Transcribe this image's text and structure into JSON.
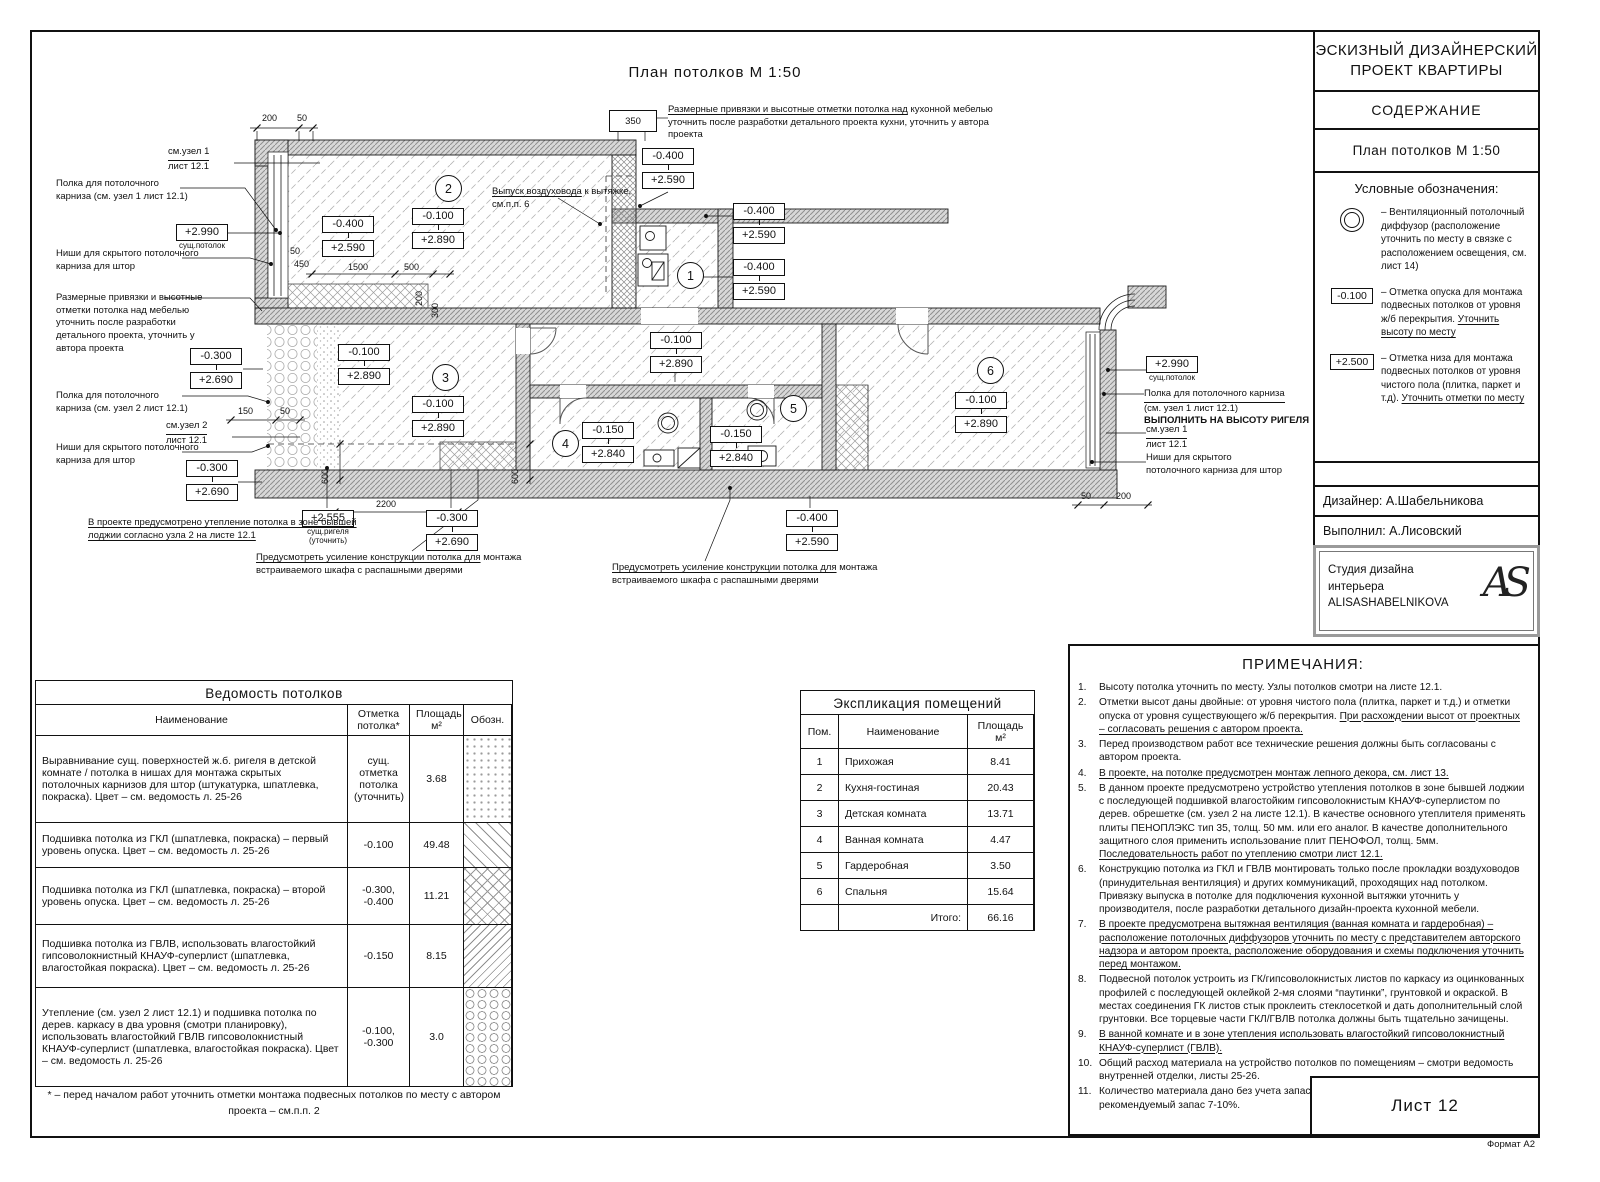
{
  "sheet": {
    "format": "Формат А2",
    "number": "Лист 12"
  },
  "plan": {
    "title": "План потолков М 1:50",
    "room_numbers": [
      "1",
      "2",
      "3",
      "4",
      "5",
      "6"
    ],
    "marks": {
      "m0400": "-0.400",
      "p2590": "+2.590",
      "m0100": "-0.100",
      "p2890": "+2.890",
      "m0300": "-0.300",
      "p2690": "+2.690",
      "m0150": "-0.150",
      "p2840": "+2.840",
      "p2990": "+2.990",
      "p2555": "+2.555"
    },
    "mark_captions": {
      "exist_ceiling": "сущ.потолок",
      "exist_beam": "сущ.ригеля\n(уточнить)"
    },
    "dims": {
      "d200": "200",
      "d50": "50",
      "d350": "350",
      "d150": "150",
      "d450": "450",
      "d1500": "1500",
      "d500": "500",
      "d300": "300",
      "d600": "600",
      "d2200": "2200"
    },
    "ann": {
      "see_node1": "см.узел 1",
      "see_node2": "см.узел 2",
      "sheet_ref": "лист 12.1",
      "shelf_node1_l1": "Полка для потолочного",
      "shelf_node1_l2": "карниза (см. узел 1 лист 12.1)",
      "shelf_node2_l1": "Полка для потолочного",
      "shelf_node2_l2": "карниза (см. узел 2 лист 12.1)",
      "niche_l1": "Ниши для скрытого потолочного",
      "niche_l2": "карниза для штор",
      "furniture_note": "Размерные привязки и высотные отметки потолка над мебелью уточнить после разработки детального проекта, уточнить у автора проекта",
      "kitchen_note_u": "Размерные привязки и высотные отметки потолка над",
      "kitchen_note_rest": "кухонной мебелью уточнить после разработки детального проекта кухни, уточнить у автора проекта",
      "duct_note_u": "Выпуск воздуховода",
      "duct_note_rest": "к вытяжке, см.п.п. 6",
      "insulation_note": "В проекте предусмотрено утепление потолка в зоне бывшей лоджии согласно узла 2 на листе 12.1",
      "wardrobe_note_u": "Предусмотреть усиление конструкции потолка для",
      "wardrobe_note_rest": "монтажа встраиваемого шкафа с распашными дверями",
      "shelf_r_l1": "Полка для потолочного карниза",
      "shelf_r_l2": "(см. узел 1 лист 12.1)",
      "beam_height_note": "ВЫПОЛНИТЬ НА ВЫСОТУ РИГЕЛЯ",
      "niche_r_l1": "Ниши для скрытого",
      "niche_r_l2": "потолочного карниза для штор"
    }
  },
  "titleblock": {
    "project_title": "ЭСКИЗНЫЙ ДИЗАЙНЕРСКИЙ\nПРОЕКТ КВАРТИРЫ",
    "contents": "СОДЕРЖАНИЕ",
    "sheet_title": "План потолков М 1:50",
    "legend_title": "Условные обозначения:",
    "leg1_text": "–  Вентиляционный потолочный диффузор (расположение уточнить по месту в связке с расположением освещения, см. лист 14)",
    "leg2_mark": "-0.100",
    "leg2_text": "–  Отметка опуска для монтажа подвесных потолков от уровня ж/б перекрытия. ",
    "leg2_underline": "Уточнить высоту по месту",
    "leg3_mark": "+2.500",
    "leg3_text": "–  Отметка низа для монтажа подвесных потолков от уровня чистого пола (плитка, паркет и т.д). ",
    "leg3_underline": "Уточнить отметки по месту",
    "designer": "Дизайнер:  А.Шабельникова",
    "executor": "Выполнил:  А.Лисовский",
    "studio": "Студия дизайна\nинтерьера\nALISASHABELNIKOVA",
    "logo": "AS"
  },
  "ceiling_table": {
    "title": "Ведомость потолков",
    "h_name": "Наименование",
    "h_mark": "Отметка потолка*",
    "h_area": "Площадь м²",
    "h_sym": "Обозн.",
    "rows": [
      {
        "name": "Выравнивание сущ. поверхностей ж.б. ригеля в детской комнате / потолка в нишах для монтажа скрытых потолочных карнизов для штор (штукатурка, шпатлевка, покраска). Цвет – см. ведомость л. 25-26",
        "mark": "сущ. отметка потолка (уточнить)",
        "area": "3.68",
        "sw_class": "sw sw-dots"
      },
      {
        "name": "Подшивка потолка из ГКЛ (шпатлевка, покраска) – первый уровень опуска. Цвет – см. ведомость л. 25-26",
        "mark": "-0.100",
        "area": "49.48",
        "sw_class": "sw sw-diag"
      },
      {
        "name": "Подшивка потолка из ГКЛ (шпатлевка, покраска) – второй уровень опуска. Цвет – см. ведомость л. 25-26",
        "mark": "-0.300, -0.400",
        "area": "11.21",
        "sw_class": "sw sw-cross"
      },
      {
        "name": "Подшивка потолка из ГВЛВ, использовать влагостойкий гипсоволокнистный КНАУФ-суперлист (шпатлевка, влагостойкая покраска). Цвет – см. ведомость л. 25-26",
        "mark": "-0.150",
        "area": "8.15",
        "sw_class": "sw sw-back"
      },
      {
        "name": "Утепление (см. узел 2 лист 12.1) и подшивка потолка по дерев. каркасу в два уровня (смотри планировку), использовать влагостойкий ГВЛВ гипсоволокнистный КНАУФ-суперлист (шпатлевка, влагостойкая покраска). Цвет – см. ведомость л. 25-26",
        "mark": "-0.100, -0.300",
        "area": "3.0",
        "sw_class": "sw sw-honey"
      }
    ],
    "footnote": "* – перед началом работ уточнить отметки монтажа подвесных потолков по месту с автором проекта – см.п.п. 2"
  },
  "rooms_table": {
    "title": "Экспликация помещений",
    "h_num": "Пом.",
    "h_name": "Наименование",
    "h_area": "Площадь м²",
    "rows": [
      {
        "num": "1",
        "name": "Прихожая",
        "area": "8.41"
      },
      {
        "num": "2",
        "name": "Кухня-гостиная",
        "area": "20.43"
      },
      {
        "num": "3",
        "name": "Детская комната",
        "area": "13.71"
      },
      {
        "num": "4",
        "name": "Ванная комната",
        "area": "4.47"
      },
      {
        "num": "5",
        "name": "Гардеробная",
        "area": "3.50"
      },
      {
        "num": "6",
        "name": "Спальня",
        "area": "15.64"
      }
    ],
    "total_label": "Итого:",
    "total": "66.16"
  },
  "notes": {
    "title": "ПРИМЕЧАНИЯ:",
    "items": [
      {
        "num": "1.",
        "pre": "Высоту потолка уточнить по месту. Узлы потолков смотри на листе 12.1.",
        "und": ""
      },
      {
        "num": "2.",
        "pre": "Отметки высот даны двойные: от уровня чистого пола (плитка, паркет  и т.д.) и отметки опуска от уровня существующего ж/б перекрытия. ",
        "und": "При расхождении высот от проектных – согласовать решения с автором проекта."
      },
      {
        "num": "3.",
        "pre": "Перед производством работ все технические решения должны быть согласованы с автором проекта.",
        "und": ""
      },
      {
        "num": "4.",
        "pre": "",
        "und": "В проекте, на потолке предусмотрен монтаж лепного декора, см. лист 13."
      },
      {
        "num": "5.",
        "pre": "В данном проекте предусмотрено устройство утепления потолков в зоне бывшей лоджии с последующей подшивкой влагостойким гипсоволокнистым КНАУФ-суперлистом по дерев. обрешетке (см. узел 2 на листе 12.1). В качестве основного утеплителя применять плиты ПЕНОПЛЭКС тип 35, толщ. 50 мм. или его аналог. В качестве дополнительного защитного слоя применить использование плит ПЕНОФОЛ, толщ. 5мм. ",
        "und": "Последовательность работ по утеплению смотри лист 12.1."
      },
      {
        "num": "6.",
        "pre": "Конструкцию потолка из ГКЛ и ГВЛВ монтировать только после прокладки воздуховодов (принудительная вентиляция) и других коммуникаций, проходящих над потолком. Привязку выпуска в потолке для подключения кухонной вытяжки уточнить у производителя, после разработки детального дизайн-проекта кухонной мебели.",
        "und": ""
      },
      {
        "num": "7.",
        "pre": "",
        "und": "В проекте предусмотрена вытяжная вентиляция (ванная комната и гардеробная) – расположение потолочных диффузоров уточнить по месту с представителем авторского надзора и автором проекта, расположение оборудования и схемы подключения уточнить перед монтажом."
      },
      {
        "num": "8.",
        "pre": "Подвесной потолок устроить из ГК/гипсоволокнистых листов по каркасу из оцинкованных профилей с последующей оклейкой 2-мя слоями “паутинки”, грунтовкой и окраской. В местах соединения ГК листов стык проклеить стеклосеткой и дать дополнительный слой грунтовки. Все торцевые части ГКЛ/ГВЛВ потолка должны быть тщательно зачищены.",
        "und": ""
      },
      {
        "num": "9.",
        "pre": "",
        "und": "В ванной комнате и в зоне утепления использовать влагостойкий гипсоволокнистный КНАУФ-суперлист (ГВЛВ)."
      },
      {
        "num": "10.",
        "pre": "Общий расход материала на устройство потолков по помещениям – смотри ведомость внутренней отделки, листы 25-26.",
        "und": ""
      },
      {
        "num": "11.",
        "pre": "Количество материала дано без учета запаса, рекомендуемый запас 7-10%.",
        "und": ""
      }
    ]
  }
}
